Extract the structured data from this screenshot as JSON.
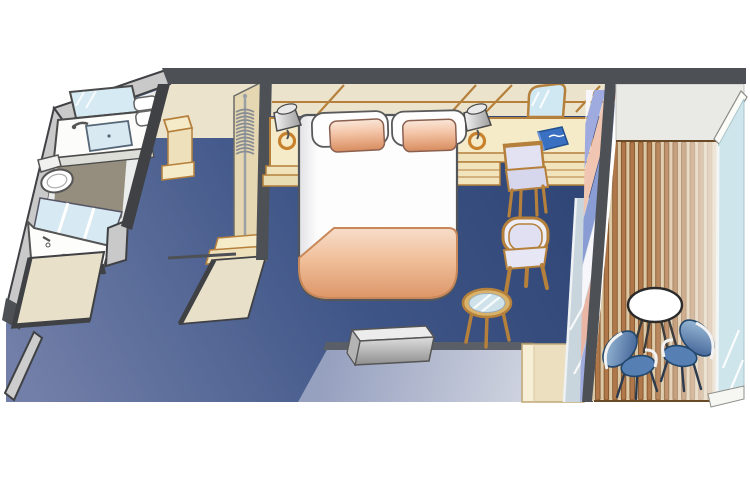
{
  "diagram": {
    "type": "stateroom-floor-plan",
    "areas": [
      {
        "id": "bathroom",
        "label": "bathroom",
        "features": [
          "mirror",
          "vanity-sink",
          "faucet",
          "towel-shelf",
          "toilet",
          "shower",
          "shower-glass-door",
          "drain"
        ]
      },
      {
        "id": "entry",
        "label": "entry",
        "features": [
          "open-entry-door",
          "door-leaf"
        ]
      },
      {
        "id": "closet",
        "label": "closet",
        "features": [
          "hanger-rod",
          "hangers",
          "luggage-shelf",
          "step-shelves",
          "open-closet-door"
        ]
      },
      {
        "id": "bedroom",
        "label": "main-cabin",
        "features": [
          "queen-bed",
          "white-pillows",
          "peach-pillows",
          "blanket",
          "nightstand",
          "lamp",
          "headboard-paneling",
          "carpet"
        ]
      },
      {
        "id": "desk-area",
        "label": "desk-area",
        "features": [
          "desk-counter",
          "drawers",
          "desk-chair",
          "desk-lamp",
          "arched-mirror",
          "blue-book"
        ]
      },
      {
        "id": "sitting-area",
        "label": "sitting-area",
        "features": [
          "armchair",
          "glass-side-table"
        ]
      },
      {
        "id": "media-wall",
        "label": "media-cabinet",
        "features": [
          "tv",
          "low-counter",
          "dresser-cabinet"
        ]
      },
      {
        "id": "balcony",
        "label": "balcony",
        "features": [
          "wood-slat-deck",
          "round-table",
          "two-blue-chairs",
          "glass-balustrade",
          "divider-wall",
          "striped-curtain",
          "sliding-glass-door"
        ]
      }
    ],
    "colors": {
      "canvas-bg": "#ffffff",
      "wall-dark": "#4d5156",
      "wall-gray": "#c9c9c9",
      "wall-edge": "#3f4144",
      "carpet-dark": "#2b4170",
      "carpet-light": "#727fa8",
      "cream-wall": "#ece3cd",
      "wood": "#b5803c",
      "furniture-cream": "#f6ebc8",
      "door-cream": "#e9e0ca",
      "peach-pillow": "#e8a878",
      "blanket-peach": "#eebc96",
      "lavender": "#e0e0f2",
      "glass-blue": "#cfe6ec",
      "slat-brown": "#b0784a",
      "deck-base": "#ddc8a5",
      "chair-blue": "#5680b4",
      "counter-blue": "#96a0bf",
      "tv-silver": "#d2d2d2",
      "book-blue": "#3a70c2",
      "bath-floor": "#958d7d",
      "ceiling-gray": "#e9e9e5",
      "lamp-base-orange": "#c8812c",
      "curtain-pink": "#e9b6a6",
      "curtain-blue": "#8a9cd4"
    }
  }
}
